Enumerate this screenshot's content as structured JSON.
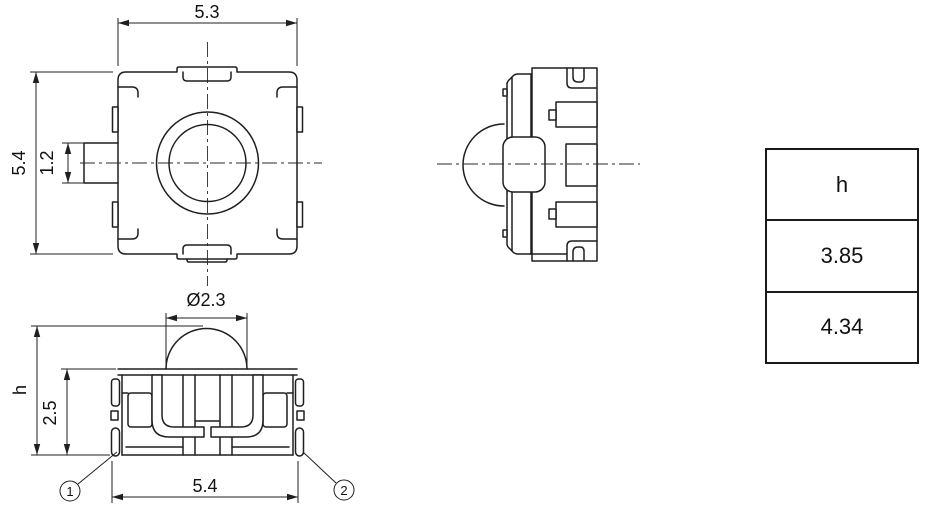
{
  "views": {
    "top": {
      "dim_width": "5.3",
      "dim_height": "5.4",
      "dim_terminal_width": "1.2"
    },
    "front": {
      "dim_plunger_diameter": "Ø2.3",
      "dim_overall_height": "h",
      "dim_body_height": "2.5",
      "dim_base_width": "5.4",
      "callouts": [
        {
          "label": "1"
        },
        {
          "label": "2"
        }
      ]
    }
  },
  "table": {
    "header": "h",
    "rows": [
      {
        "value": "3.85"
      },
      {
        "value": "4.34"
      }
    ]
  },
  "colors": {
    "line": "#1f1f1f",
    "background": "#ffffff"
  }
}
